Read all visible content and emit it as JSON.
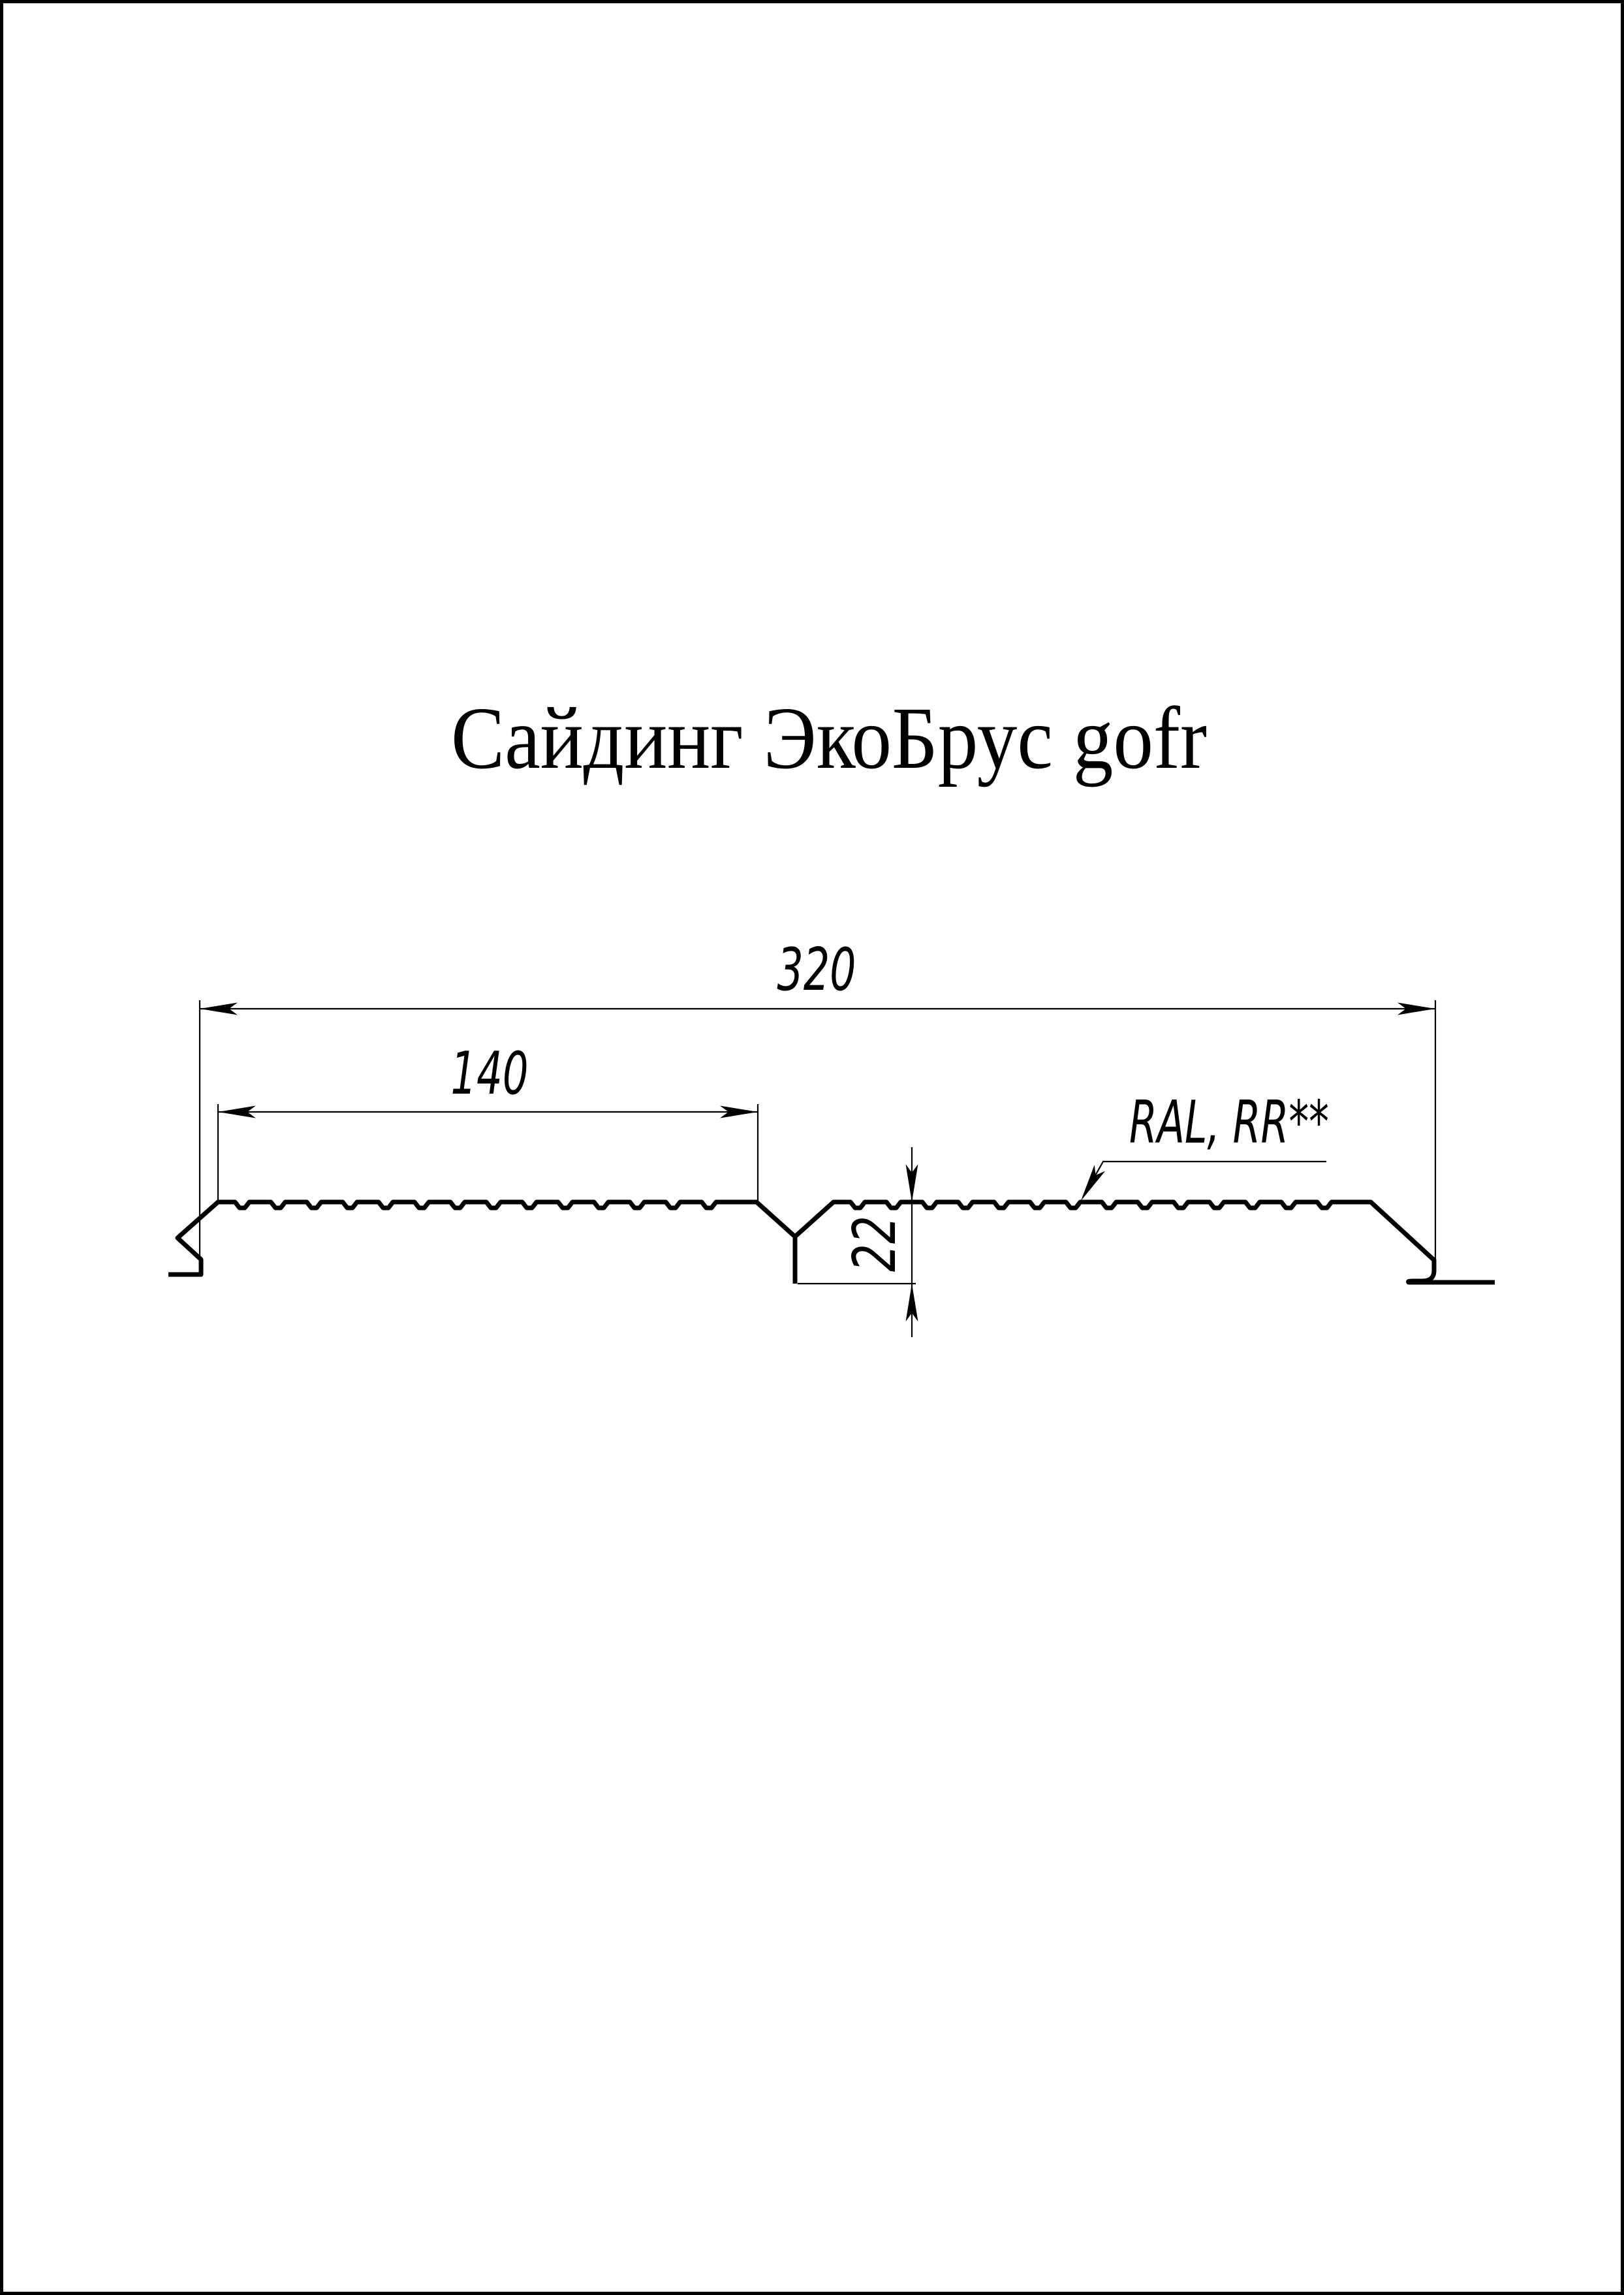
{
  "page": {
    "background": "#ffffff",
    "frame_color": "#000000",
    "line_color": "#000000",
    "title": "Сайдинг ЭкоБрус gofr"
  },
  "drawing": {
    "type": "siding-profile-cross-section",
    "corrugation": "gofr",
    "dimensions": {
      "overall_width": {
        "label": "320",
        "value_mm": 320,
        "orientation": "horizontal"
      },
      "panel_width": {
        "label": "140",
        "value_mm": 140,
        "orientation": "horizontal"
      },
      "profile_height": {
        "label": "22",
        "value_mm": 22,
        "orientation": "vertical"
      }
    },
    "coating_label": "RAL, RR**"
  }
}
